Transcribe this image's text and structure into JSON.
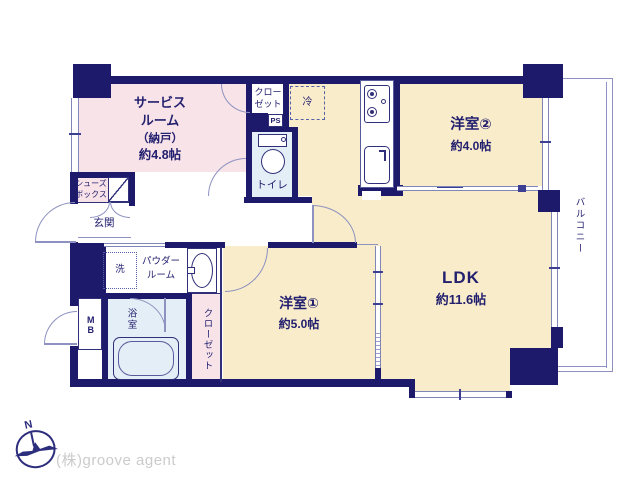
{
  "colors": {
    "wall": "#1d1a6b",
    "room_pink": "#f8e3e8",
    "room_beige": "#f9ecca",
    "room_blue": "#e4eef6",
    "line_gray": "#8d92c0",
    "text_navy": "#23206f",
    "agency_gray": "#cbcbcb"
  },
  "rooms": {
    "service_room": {
      "line1": "サービス",
      "line2": "ルーム",
      "line3": "（納戸）",
      "size": "約4.8帖"
    },
    "closet_upper": {
      "line1": "クロー",
      "line2": "ゼット"
    },
    "pipe_space": {
      "name": "PS"
    },
    "refrigerator": {
      "name": "冷"
    },
    "toilet": {
      "name": "トイレ"
    },
    "western_room_2": {
      "name": "洋室②",
      "size": "約4.0帖"
    },
    "ldk": {
      "name": "LDK",
      "size": "約11.6帖"
    },
    "western_room_1": {
      "name": "洋室①",
      "size": "約5.0帖"
    },
    "closet_lower": {
      "name": "クローゼット"
    },
    "bathroom": {
      "name": "浴室"
    },
    "meter_box": {
      "name": "MB"
    },
    "washing_machine": {
      "name": "洗"
    },
    "powder_room": {
      "line1": "パウダー",
      "line2": "ルーム"
    },
    "entrance": {
      "name": "玄関"
    },
    "shoe_box": {
      "line1": "シューズ",
      "line2": "ボックス"
    },
    "balcony": {
      "name": "バルコニー"
    }
  },
  "footer": {
    "compass_north": "N",
    "agency": "(株)groove agent"
  }
}
